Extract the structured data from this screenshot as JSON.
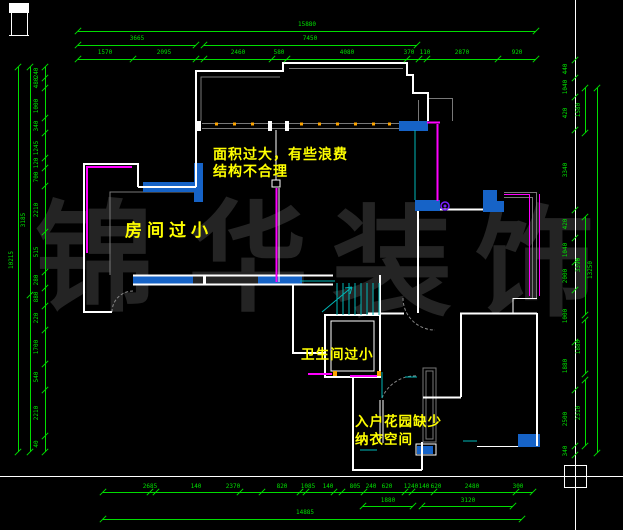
{
  "watermark": {
    "char1": "锦",
    "char2": "华",
    "char3": "装",
    "char4": "饰"
  },
  "annotations": {
    "area_note_line1": "面积过大，有些浪费",
    "area_note_line2": "结构不合理",
    "room_small": "房间过小",
    "bathroom_small": "卫生间过小",
    "entry_note_line1": "入户花园缺少",
    "entry_note_line2": "纳衣空间"
  },
  "colors": {
    "dimension_green": "#00dd00",
    "wall_white": "#ffffff",
    "window_magenta": "#ff00ff",
    "wall_fill_blue": "#1663c7",
    "stair_cyan": "#00b7b7",
    "note_yellow": "#ffff00",
    "watermark_gray": "#242424",
    "secondary_gray": "#787878",
    "marker_orange": "#ffa500",
    "door_symbol_purple": "#7a1fff"
  },
  "dim_chains": [
    {
      "name": "top-total",
      "line": [
        78,
        31,
        536,
        31
      ],
      "ticks": [
        78,
        536
      ],
      "labels": [
        {
          "t": "15880",
          "x": 307,
          "y": 25
        }
      ]
    },
    {
      "name": "top-sub-left",
      "line": [
        78,
        45,
        196,
        45
      ],
      "ticks": [
        78,
        196
      ],
      "labels": [
        {
          "t": "3665",
          "x": 137,
          "y": 39
        }
      ]
    },
    {
      "name": "top-sub-right",
      "line": [
        204,
        45,
        417,
        45
      ],
      "ticks": [
        204,
        417
      ],
      "labels": [
        {
          "t": "7450",
          "x": 310,
          "y": 39
        }
      ]
    },
    {
      "name": "top-chain",
      "line": [
        78,
        59,
        536,
        59
      ],
      "ticks": [
        78,
        133,
        196,
        204,
        272,
        287,
        407,
        419,
        427,
        498,
        536
      ],
      "labels": [
        {
          "t": "1570",
          "x": 105,
          "y": 53
        },
        {
          "t": "2095",
          "x": 164,
          "y": 53
        },
        {
          "t": "2460",
          "x": 238,
          "y": 53
        },
        {
          "t": "580",
          "x": 279,
          "y": 53
        },
        {
          "t": "4080",
          "x": 347,
          "y": 53
        },
        {
          "t": "370",
          "x": 409,
          "y": 53
        },
        {
          "t": "110",
          "x": 425,
          "y": 53
        },
        {
          "t": "2870",
          "x": 462,
          "y": 53
        },
        {
          "t": "920",
          "x": 517,
          "y": 53
        }
      ]
    },
    {
      "name": "bottom-chain",
      "line": [
        103,
        492,
        533,
        492
      ],
      "ticks": [
        103,
        150,
        156,
        240,
        262,
        300,
        306,
        334,
        342,
        364,
        405,
        412,
        434,
        516,
        533
      ],
      "labels": [
        {
          "t": "2685",
          "x": 150,
          "y": 487
        },
        {
          "t": "140",
          "x": 196,
          "y": 487
        },
        {
          "t": "2370",
          "x": 233,
          "y": 487
        },
        {
          "t": "820",
          "x": 282,
          "y": 487
        },
        {
          "t": "1085",
          "x": 308,
          "y": 487
        },
        {
          "t": "140",
          "x": 328,
          "y": 487
        },
        {
          "t": "805",
          "x": 355,
          "y": 487
        },
        {
          "t": "240",
          "x": 371,
          "y": 487
        },
        {
          "t": "620",
          "x": 387,
          "y": 487
        },
        {
          "t": "1240",
          "x": 411,
          "y": 487
        },
        {
          "t": "140",
          "x": 424,
          "y": 487
        },
        {
          "t": "620",
          "x": 436,
          "y": 487
        },
        {
          "t": "2480",
          "x": 472,
          "y": 487
        },
        {
          "t": "300",
          "x": 518,
          "y": 487
        }
      ]
    },
    {
      "name": "bottom-sub-1",
      "line": [
        363,
        506,
        413,
        506
      ],
      "ticks": [
        363,
        413
      ],
      "labels": [
        {
          "t": "1880",
          "x": 388,
          "y": 501
        }
      ]
    },
    {
      "name": "bottom-sub-2",
      "line": [
        422,
        506,
        513,
        506
      ],
      "ticks": [
        422,
        513
      ],
      "labels": [
        {
          "t": "3120",
          "x": 468,
          "y": 501
        }
      ]
    },
    {
      "name": "bottom-total",
      "line": [
        103,
        519,
        522,
        519
      ],
      "ticks": [
        103,
        522
      ],
      "labels": [
        {
          "t": "14885",
          "x": 305,
          "y": 513
        }
      ]
    },
    {
      "name": "left-chain",
      "v": true,
      "line": [
        45,
        67,
        45,
        452
      ],
      "ticks": [
        67,
        78,
        88,
        118,
        133,
        158,
        168,
        186,
        232,
        272,
        288,
        306,
        330,
        364,
        390,
        436,
        452
      ],
      "labels": [
        {
          "t": "240",
          "x": 37,
          "y": 73
        },
        {
          "t": "480",
          "x": 37,
          "y": 83
        },
        {
          "t": "1000",
          "x": 37,
          "y": 106
        },
        {
          "t": "340",
          "x": 37,
          "y": 126
        },
        {
          "t": "1245",
          "x": 37,
          "y": 148
        },
        {
          "t": "120",
          "x": 37,
          "y": 163
        },
        {
          "t": "700",
          "x": 37,
          "y": 177
        },
        {
          "t": "2210",
          "x": 37,
          "y": 210
        },
        {
          "t": "515",
          "x": 37,
          "y": 252
        },
        {
          "t": "280",
          "x": 37,
          "y": 280
        },
        {
          "t": "880",
          "x": 37,
          "y": 297
        },
        {
          "t": "220",
          "x": 37,
          "y": 318
        },
        {
          "t": "1700",
          "x": 37,
          "y": 347
        },
        {
          "t": "540",
          "x": 37,
          "y": 377
        },
        {
          "t": "2210",
          "x": 37,
          "y": 413
        },
        {
          "t": "40",
          "x": 37,
          "y": 444
        }
      ]
    },
    {
      "name": "left-mid",
      "v": true,
      "line": [
        30,
        67,
        30,
        452
      ],
      "ticks": [
        67,
        295,
        452
      ],
      "labels": [
        {
          "t": "3185",
          "x": 24,
          "y": 220
        }
      ]
    },
    {
      "name": "left-total",
      "v": true,
      "line": [
        18,
        67,
        18,
        452
      ],
      "ticks": [
        67,
        452
      ],
      "labels": [
        {
          "t": "10215",
          "x": 12,
          "y": 260
        }
      ]
    },
    {
      "name": "right-chain",
      "v": true,
      "line": null,
      "ticksx": 575,
      "ticks": [
        60,
        78,
        97,
        130,
        210,
        238,
        262,
        290,
        342,
        390,
        446,
        455
      ],
      "labels": [
        {
          "t": "440",
          "x": 566,
          "y": 69
        },
        {
          "t": "1040",
          "x": 566,
          "y": 87
        },
        {
          "t": "420",
          "x": 566,
          "y": 113
        },
        {
          "t": "3340",
          "x": 566,
          "y": 170
        },
        {
          "t": "420",
          "x": 566,
          "y": 224
        },
        {
          "t": "1040",
          "x": 566,
          "y": 250
        },
        {
          "t": "2000",
          "x": 566,
          "y": 276
        },
        {
          "t": "1000",
          "x": 566,
          "y": 316
        },
        {
          "t": "1880",
          "x": 566,
          "y": 366
        },
        {
          "t": "2500",
          "x": 566,
          "y": 419
        },
        {
          "t": "340",
          "x": 566,
          "y": 451
        }
      ]
    },
    {
      "name": "right-sub-1",
      "v": true,
      "line": [
        585,
        88,
        585,
        133
      ],
      "ticks": [
        88,
        133
      ],
      "labels": [
        {
          "t": "1580",
          "x": 579,
          "y": 110
        }
      ]
    },
    {
      "name": "right-sub-2",
      "v": true,
      "line": [
        585,
        217,
        585,
        315
      ],
      "ticks": [
        217,
        315
      ],
      "labels": [
        {
          "t": "3390",
          "x": 579,
          "y": 265
        }
      ]
    },
    {
      "name": "right-sub-3",
      "v": true,
      "line": [
        585,
        320,
        585,
        374
      ],
      "ticks": [
        320,
        374
      ],
      "labels": [
        {
          "t": "1880",
          "x": 579,
          "y": 347
        }
      ]
    },
    {
      "name": "right-sub-4",
      "v": true,
      "line": [
        585,
        380,
        585,
        446
      ],
      "ticks": [
        380,
        446
      ],
      "labels": [
        {
          "t": "2310",
          "x": 579,
          "y": 413
        }
      ]
    },
    {
      "name": "right-total",
      "v": true,
      "line": [
        597,
        88,
        597,
        453
      ],
      "ticks": [
        88,
        453
      ],
      "labels": [
        {
          "t": "13250",
          "x": 591,
          "y": 270
        }
      ]
    }
  ]
}
